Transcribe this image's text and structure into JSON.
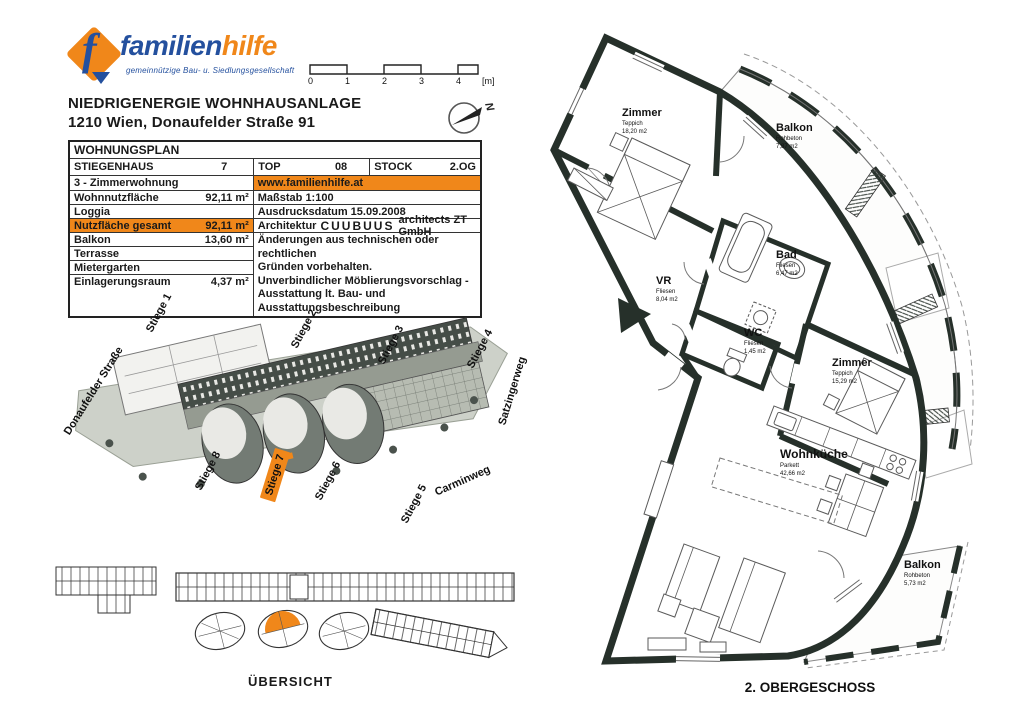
{
  "logo": {
    "f_glyph": "f",
    "word_part1": "familien",
    "word_part2": "hilfe",
    "subtitle": "gemeinnützige Bau- u. Siedlungsgesellschaft"
  },
  "scalebar": {
    "ticks": [
      "0",
      "1",
      "2",
      "3",
      "4"
    ],
    "unit": "[m]"
  },
  "north_letter": "N",
  "title": {
    "line1": "NIEDRIGENERGIE WOHNHAUSANLAGE",
    "line2": "1210 Wien, Donaufelder Straße 91"
  },
  "plan_table": {
    "header": "WOHNUNGSPLAN",
    "stiegenhaus_label": "STIEGENHAUS",
    "stiegenhaus_value": "7",
    "top_label": "TOP",
    "top_value": "08",
    "stock_label": "STOCK",
    "stock_value": "2.OG",
    "left_rows": [
      {
        "label": "3 - Zimmerwohnung",
        "value": ""
      },
      {
        "label": "Wohnnutzfläche",
        "value": "92,11 m²"
      },
      {
        "label": "Loggia",
        "value": ""
      },
      {
        "label": "Nutzfläche gesamt",
        "value": "92,11 m²"
      },
      {
        "label": "Balkon",
        "value": "13,60 m²"
      },
      {
        "label": "Terrasse",
        "value": ""
      },
      {
        "label": "Mietergarten",
        "value": ""
      },
      {
        "label": "Einlagerungsraum",
        "value": "4,37 m²"
      }
    ],
    "website": "www.familienhilfe.at",
    "massstab": "Maßstab  1:100",
    "druckdatum": "Ausdrucksdatum  15.09.2008",
    "architektur_label": "Architektur",
    "architektur_brand": "CUUBUUS",
    "architektur_rest": "architects ZT GmbH",
    "note_lines": [
      "Änderungen aus technischen oder rechtlichen",
      "Gründen vorbehalten.",
      "Unverbindlicher Möblierungsvorschlag -",
      "Ausstattung lt. Bau- und Ausstattungsbeschreibung"
    ]
  },
  "siteplan": {
    "street_donaufelder": "Donaufelder Straße",
    "street_satzingerweg": "Satzingerweg",
    "street_carminweg": "Carminweg",
    "stiegen": [
      "Stiege 1",
      "Stiege 2",
      "Stiege 3",
      "Stiege 4",
      "Stiege 5",
      "Stiege 6",
      "Stiege 7",
      "Stiege 8"
    ],
    "highlighted": "Stiege 7"
  },
  "overview_label": "ÜBERSICHT",
  "floorplan": {
    "caption": "2.  OBERGESCHOSS",
    "rooms": {
      "zimmer1": {
        "name": "Zimmer",
        "material": "Teppich",
        "area": "18,20 m2"
      },
      "balkon1": {
        "name": "Balkon",
        "material": "Rohbeton",
        "area": "7,87 m2"
      },
      "bad": {
        "name": "Bad",
        "material": "Fliesen",
        "area": "6,47 m2"
      },
      "vr": {
        "name": "VR",
        "material": "Fliesen",
        "area": "8,04 m2"
      },
      "wc": {
        "name": "WC",
        "material": "Fliesen",
        "area": "1,45 m2"
      },
      "zimmer2": {
        "name": "Zimmer",
        "material": "Teppich",
        "area": "15,29 m2"
      },
      "wohnkueche": {
        "name": "Wohnküche",
        "material": "Parkett",
        "area": "42,66 m2"
      },
      "balkon2": {
        "name": "Balkon",
        "material": "Rohbeton",
        "area": "5,73 m2"
      }
    }
  },
  "colors": {
    "accent_orange": "#F0871A",
    "logo_blue": "#24509E",
    "wall_dark": "#26302A"
  }
}
